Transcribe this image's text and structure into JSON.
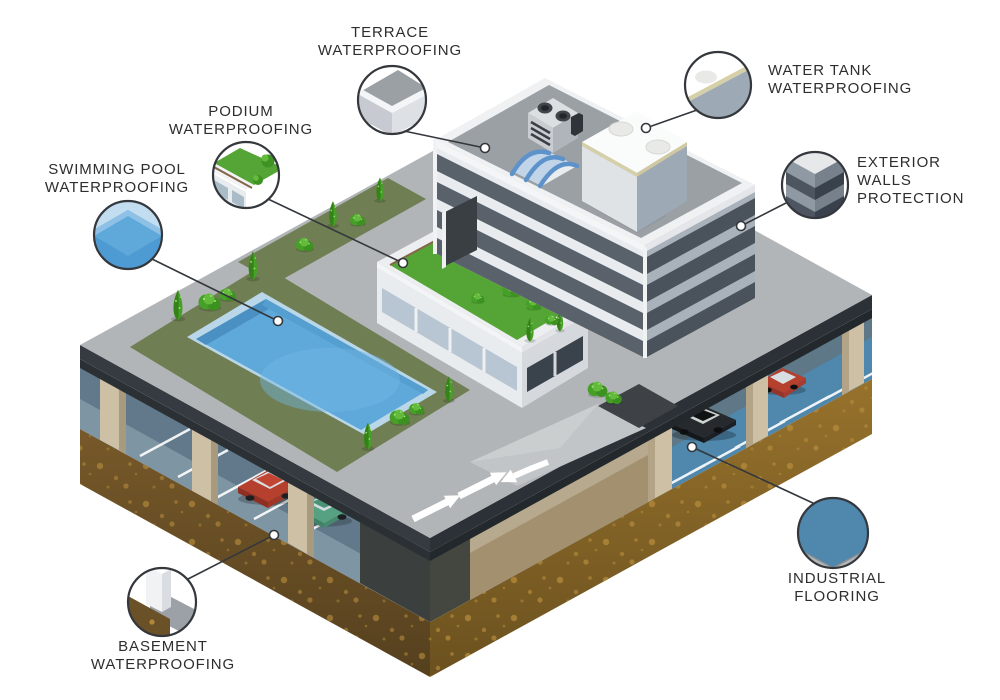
{
  "title": "Building waterproofing applications — isometric diagram",
  "labels": {
    "terrace": {
      "text": "TERRACE\nWATERPROOFING"
    },
    "water_tank": {
      "text": "WATER TANK\nWATERPROOFING"
    },
    "podium": {
      "text": "PODIUM\nWATERPROOFING"
    },
    "swimming_pool": {
      "text": "SWIMMING POOL\nWATERPROOFING"
    },
    "exterior_walls": {
      "text": "EXTERIOR\nWALLS\nPROTECTION"
    },
    "industrial_flooring": {
      "text": "INDUSTRIAL\nFLOORING"
    },
    "basement": {
      "text": "BASEMENT\nWATERPROOFING"
    }
  },
  "callouts": [
    "terrace-waterproofing",
    "water-tank-waterproofing",
    "podium-waterproofing",
    "swimming-pool-waterproofing",
    "exterior-walls-protection",
    "industrial-flooring",
    "basement-waterproofing"
  ],
  "colors": {
    "label_text": "#2e2e2e",
    "callout_line": "#34383d",
    "deck": "#b2b5b7",
    "deck_edge": "#363b41",
    "lawn": "#6f7e53",
    "podium_grass": "#55a536",
    "pool_water": "#5ea9da",
    "pool_rim": "#bad7e9",
    "industrial_floor": "#4f87ad",
    "soil_left_top": "#77592a",
    "soil_left_bottom": "#55401e",
    "soil_right_top": "#97722c",
    "soil_right_bottom": "#6b511f",
    "soil_speckle": "#b1883a",
    "building_light": "#e9ecef",
    "building_band": "#59616b",
    "water_tank_trim": "#d6d0a8",
    "pillar": "#cdc0a5",
    "car_red": "#b6402e",
    "car_green": "#55a182",
    "car_black": "#26292d"
  }
}
